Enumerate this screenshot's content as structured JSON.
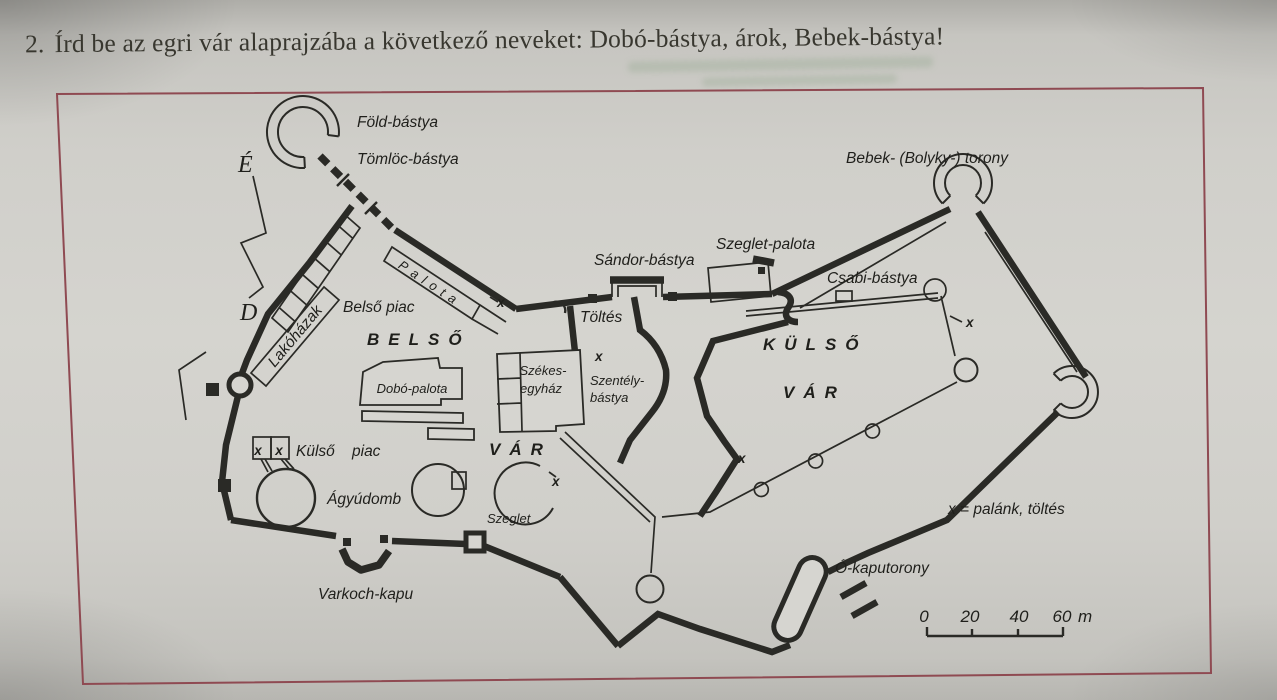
{
  "header": {
    "number": "2.",
    "text": "Írd be az egri vár alaprajzába a következő neveket: Dobó-bástya, árok, Bebek-bástya!"
  },
  "diagram": {
    "compass": {
      "north": "É",
      "south": "D"
    },
    "labels": {
      "fold_bastya": "Föld-bástya",
      "tomloc_bastya": "Tömlöc-bástya",
      "bebek_torony": "Bebek- (Bolyky-) torony",
      "sandor_bastya": "Sándor-bástya",
      "szeglet_palota": "Szeglet-palota",
      "csabi_bastya": "Csabi-bástya",
      "palota": "Palota",
      "belso_piac": "Belső piac",
      "belso": "BELSŐ",
      "kulso": "KÜLSŐ",
      "var_belso": "VÁR",
      "var_kulso": "VÁR",
      "toltes": "Töltés",
      "lakohazak": "Lakóházak",
      "szekesegyhaz_line1": "Székes-",
      "szekesegyhaz_line2": "egyház",
      "szentely_line1": "Szentély-",
      "szentely_line2": "bástya",
      "dobo_palota": "Dobó-palota",
      "kulso_piac_word1": "Külső",
      "kulso_piac_word2": "piac",
      "agyudomb": "Ágyúdomb",
      "szeglet": "Szeglet",
      "varkoch_kapu": "Varkoch-kapu",
      "o_kaputorony": "Ó-kaputorony"
    },
    "marks": {
      "x_mark": "x"
    },
    "legend": {
      "text": "x = palánk, töltés"
    },
    "scale": {
      "n0": "0",
      "n20": "20",
      "n40": "40",
      "n60": "60",
      "unit": "m"
    }
  },
  "colors": {
    "ink": "#2a2a26",
    "frame_border": "#8f4a52",
    "paper": "#d2d1cc"
  }
}
